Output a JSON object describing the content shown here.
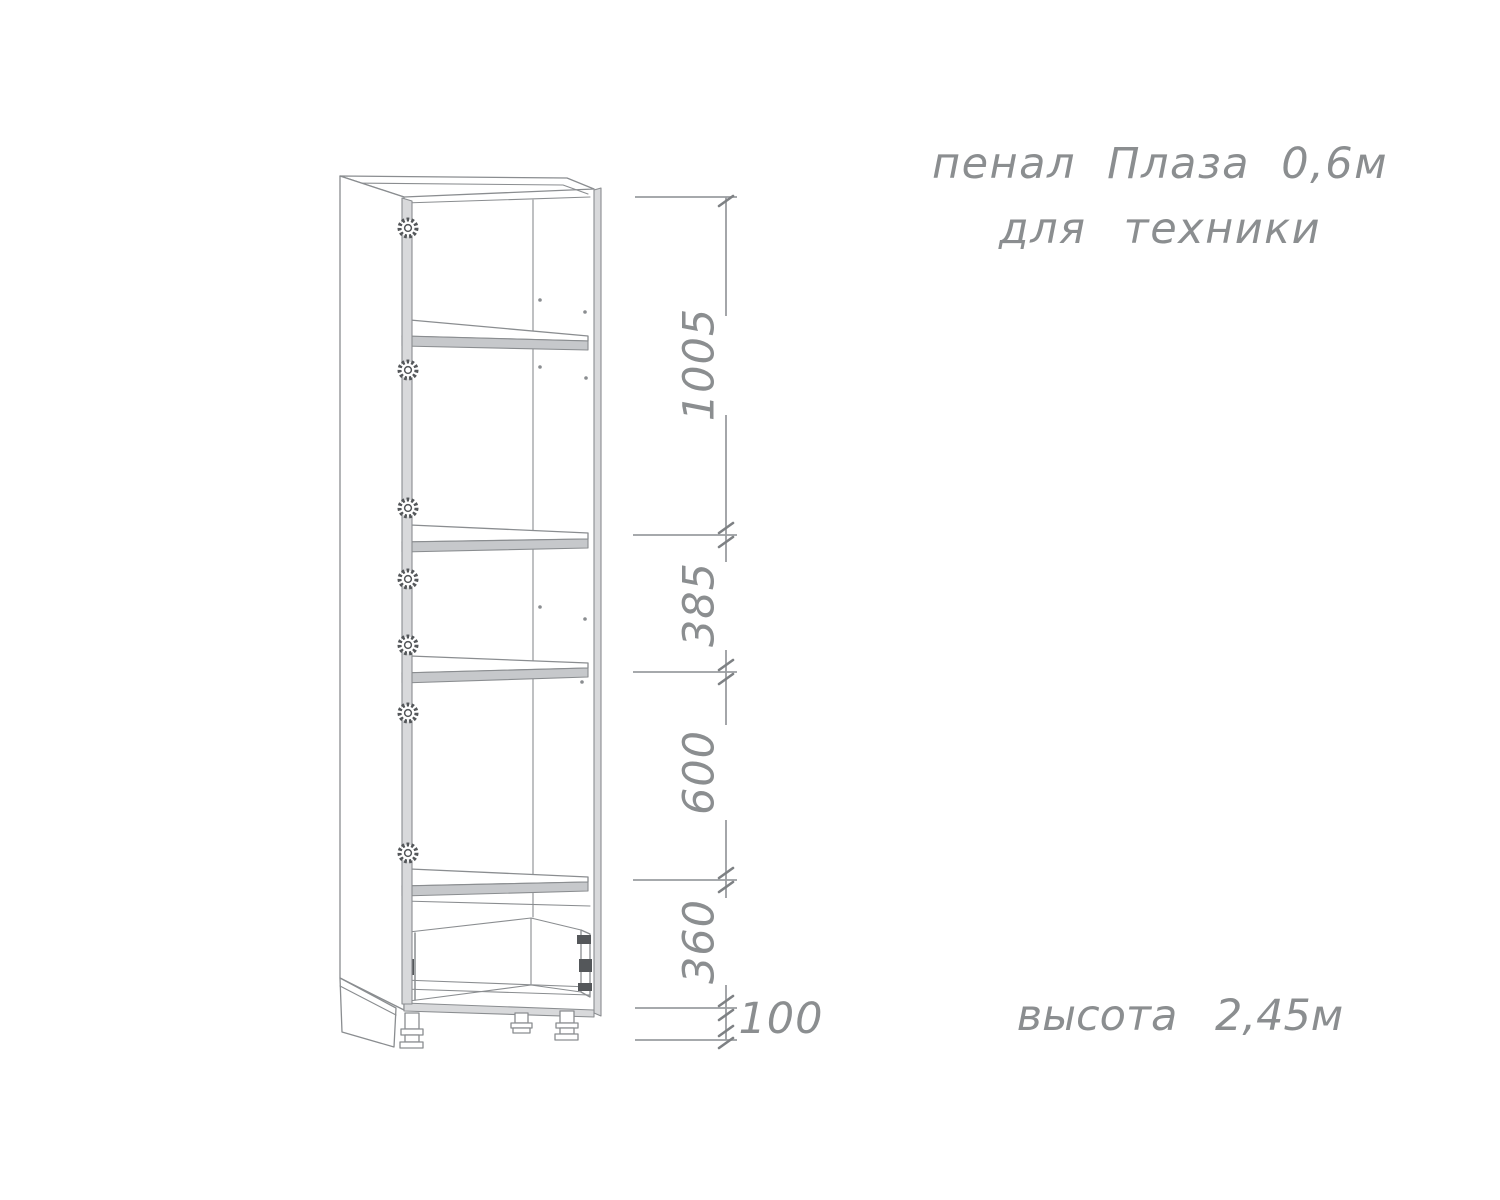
{
  "annotation": {
    "title_line1": "пенал Плаза 0,6м",
    "title_line2": "для техники",
    "height_note": "высота 2,45м"
  },
  "dimensions": {
    "labels": [
      {
        "value": "1005",
        "orientation": "vertical"
      },
      {
        "value": "385",
        "orientation": "vertical"
      },
      {
        "value": "600",
        "orientation": "vertical"
      },
      {
        "value": "360",
        "orientation": "vertical"
      },
      {
        "value": "100",
        "orientation": "horizontal"
      }
    ]
  },
  "colors": {
    "background": "#ffffff",
    "drawing_line": "#8a8d90",
    "text": "#8b8e90",
    "dimension_line": "#9a9da0",
    "tick_mark": "#7e8184",
    "panel_band_fill": "#d8d9db",
    "shelf_edge_fill": "#c6c8cb",
    "fitting_dark": "#54575a"
  }
}
